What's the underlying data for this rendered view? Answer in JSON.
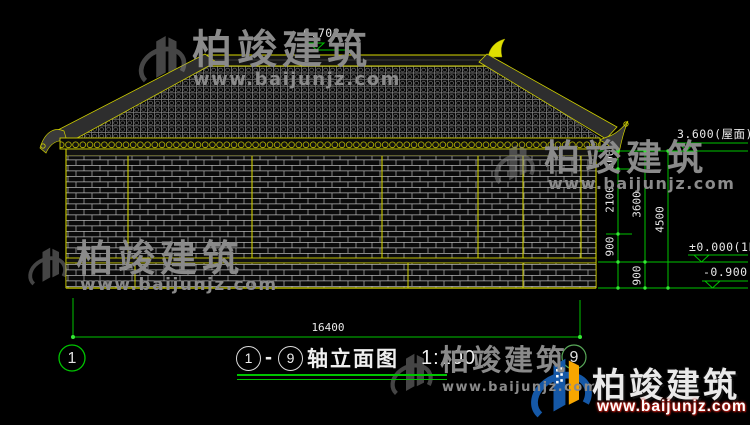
{
  "levels": {
    "ridge": "6.708",
    "eave": "3.600(屋面)",
    "first_floor": "±0.000(1F)",
    "ground": "-0.900"
  },
  "dimensions": {
    "seg_600": "600",
    "seg_2100": "2100",
    "seg_900a": "900",
    "seg_3600": "3600",
    "seg_900b": "900",
    "seg_4500": "4500",
    "total_width": "16400"
  },
  "axes": {
    "left": "1",
    "right": "9"
  },
  "title": {
    "axis_start": "1",
    "dash": "-",
    "axis_end": "9",
    "name": "轴立面图",
    "scale": "1:100"
  },
  "watermark": {
    "brand": "柏竣建筑",
    "url": "www.baijunjz.com"
  },
  "colors": {
    "line_yellow": "#d8d800",
    "dim_green": "#00c400",
    "wm_gray": "#8a8a8a",
    "logo_blue": "#1558a7",
    "logo_orange": "#f7a600",
    "url_red": "#c22016"
  }
}
